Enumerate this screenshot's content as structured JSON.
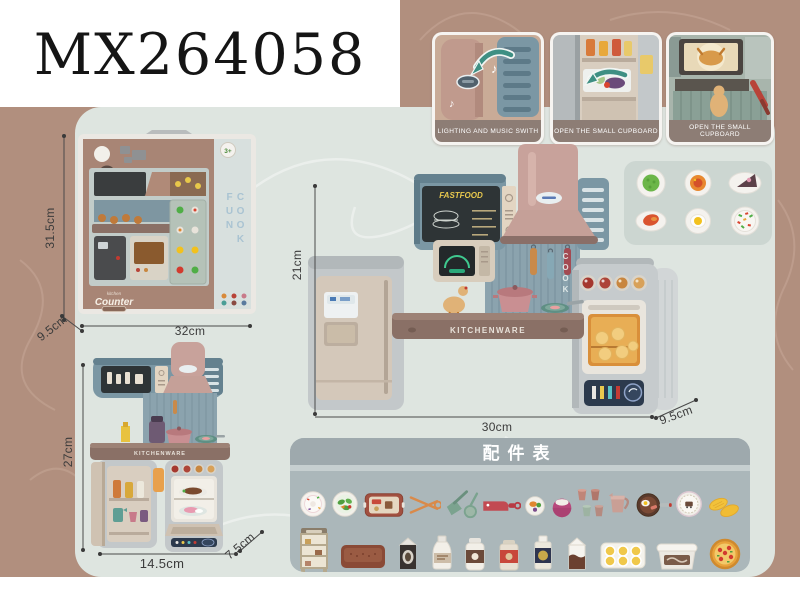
{
  "title": "MX264058",
  "callouts": [
    {
      "label": "LIGHTING AND MUSIC SWITH"
    },
    {
      "label": "OPEN THE SMALL CUPBOARD"
    },
    {
      "label": "OPEN THE SMALL CUPBOARD"
    }
  ],
  "figures": {
    "box": {
      "height_label": "31.5cm",
      "width_label": "32cm",
      "depth_label": "9.5cm",
      "age_badge": "3+",
      "feature_badge": "2 IN 1",
      "brand_small": "kitchen",
      "brand": "Counter",
      "side_text": "COOK FUN"
    },
    "main": {
      "height_label": "21cm",
      "width_label": "30cm",
      "depth_label": "9.5cm",
      "menu_sign": "FASTFOOD",
      "counter_text": "KITCHENWARE",
      "wall_text": "COOK"
    },
    "small": {
      "height_label": "27cm",
      "width_label": "14.5cm",
      "depth_label": "7.5cm",
      "counter_text": "KITCHENWARE"
    }
  },
  "plates_panel": {
    "items": [
      "peas-plate",
      "tomato-plate",
      "cake-slice-plate",
      "seafood-plate",
      "fried-egg-plate",
      "veggie-plate"
    ]
  },
  "accessories": {
    "header": "配件表",
    "row1": [
      "birthday-cake",
      "salad-plate",
      "serving-tray",
      "tongs",
      "shovel-ladle",
      "cleaver",
      "fruit-plate",
      "dessert-bowl",
      "cups",
      "measuring-cup",
      "breakfast-pan",
      "pattern-plate",
      "corn"
    ],
    "row2": [
      "display-rack",
      "baking-tray",
      "milk-carton",
      "milk-bottle",
      "milk-jug",
      "sauce-jar",
      "oil-bottle",
      "cocoa-carton",
      "egg-tray",
      "ice-cream-tub",
      "pizza"
    ]
  },
  "icons": {
    "music_note": "♪"
  },
  "colors": {
    "background": "#b18f7e",
    "card": "#dee5e0",
    "panel": "#abb7ba",
    "panel_header": "#9ea9ad",
    "callout_label": "#8d7d75",
    "accent_arrow": "#3e8f83",
    "hood_pink": "#c8a29b",
    "frame_blue": "#7b97a4",
    "counter_brown": "#8a7066",
    "menu_yellow": "#e9c94e"
  }
}
